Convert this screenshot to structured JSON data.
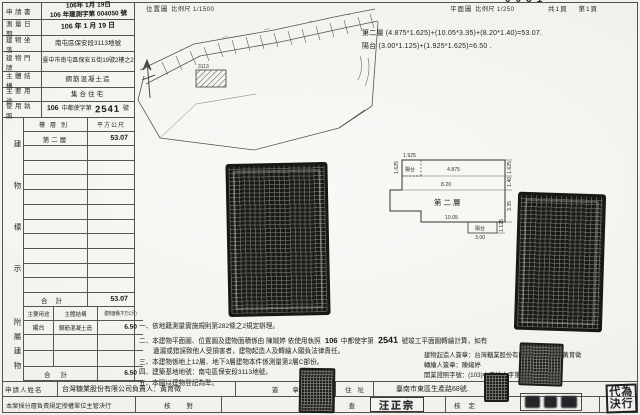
{
  "header": {
    "location_map_title": "位置圖",
    "location_map_scale": "比例尺 1/1500",
    "plan_title": "平面圖",
    "plan_scale": "比例尺 1/250",
    "pages_total": "共1頁",
    "page_no": "第1頁",
    "clipped_digits": "0031"
  },
  "info_rows": [
    {
      "label": "申請書",
      "line1": "106年 1月 19日",
      "line2": "106 年建測字第 004050 號"
    },
    {
      "label": "測量日期",
      "value": "106 年 1 月 19 日"
    },
    {
      "label": "建物坐落",
      "value": "南屯區保安段3113地號"
    },
    {
      "label": "建物門牌",
      "value": "臺中市南屯區保安五街19號2樓之2"
    },
    {
      "label": "主體結構",
      "value": "鋼筋混凝土造"
    },
    {
      "label": "主要用途",
      "value": "集合住宅"
    },
    {
      "label": "使用執照",
      "year": "106",
      "prefix": "中都使字第",
      "number": "2541",
      "suffix": "號"
    }
  ],
  "building_table": {
    "side_label": "建物標示",
    "col_floor": "樓層別",
    "col_area": "平方公尺",
    "floor": "第二層",
    "floor_area": "53.07",
    "total_label": "合計",
    "total_area": "53.07"
  },
  "annex_table": {
    "side_label": "附屬建物",
    "col_use": "主要用途",
    "col_structure": "主體結構",
    "col_area": "建物面積(平方公尺)",
    "use": "陽台",
    "structure": "鋼筋混凝土造",
    "area": "6.50",
    "total_label": "合計",
    "total_area": "6.50"
  },
  "formulas": {
    "line1": "第二層 (4.875*1.625)+(10.05*3.35)+(8.20*1.40)=53.07.",
    "line2": "陽台 (3.00*1.125)+(1.925*1.625)=6.50 ."
  },
  "floor_plan": {
    "room": "第二層",
    "balcony_top": "陽台",
    "balcony_bottom": "陽台",
    "dim_top": "1.925",
    "dim_left": "1.625",
    "dim_right_top": "1.625",
    "dim_right_mid": "1.40",
    "dim_right_low": "3.35",
    "dim_right_balcony": "1.125",
    "dim_width_top": "4.875",
    "dim_width_mid": "8.20",
    "dim_width_bottom": "10.05",
    "dim_balcony_width": "3.00"
  },
  "location_map": {
    "subject_lot": "3113"
  },
  "notes": {
    "n1": "一、依地籍測量實施規則第282條之2規定辦理。",
    "n2a": "二、本建物平面圖、位置圖及建物面積係由 陳婌婷 依使用執照",
    "n2_year": "106",
    "n2_mid": "中都使字第",
    "n2_no": "2541",
    "n2b": "號竣工平面圖轉繪計算，如有",
    "n2c": "遺漏或錯誤致他人受損害者，建物起造人及轉繪人願負法律責任。",
    "n3": "三、本建物係地上12層、地下3層建物本件係測量第2層C部份。",
    "n4": "四、建築基地地號：南屯區保安段3113地號。",
    "n5": "五、本圖以建物登記為準。"
  },
  "signer_block": {
    "line1": "建物起造人簽章：台灣糖業股份有限公司負責人：黃育徵",
    "line2": "轉繪人簽章：陳婌婷",
    "line3": "開業證照字號：(103)中市地士字第001038號"
  },
  "applicant_row": {
    "label": "申請人姓名",
    "name": "台灣糖業股份有限公司負責人：黃育徵",
    "sign_label": "簽章",
    "address_label": "住址",
    "address": "臺南市東區生產路68號."
  },
  "review_row": {
    "policy": "本案採分層負責規定授權單位主管決行",
    "check1": "核對",
    "check2": "檢查",
    "approve": "核定"
  },
  "stamps": {
    "examiner_name": "汪正宗",
    "delegate_line1": "代為",
    "delegate_line2": "決行"
  }
}
